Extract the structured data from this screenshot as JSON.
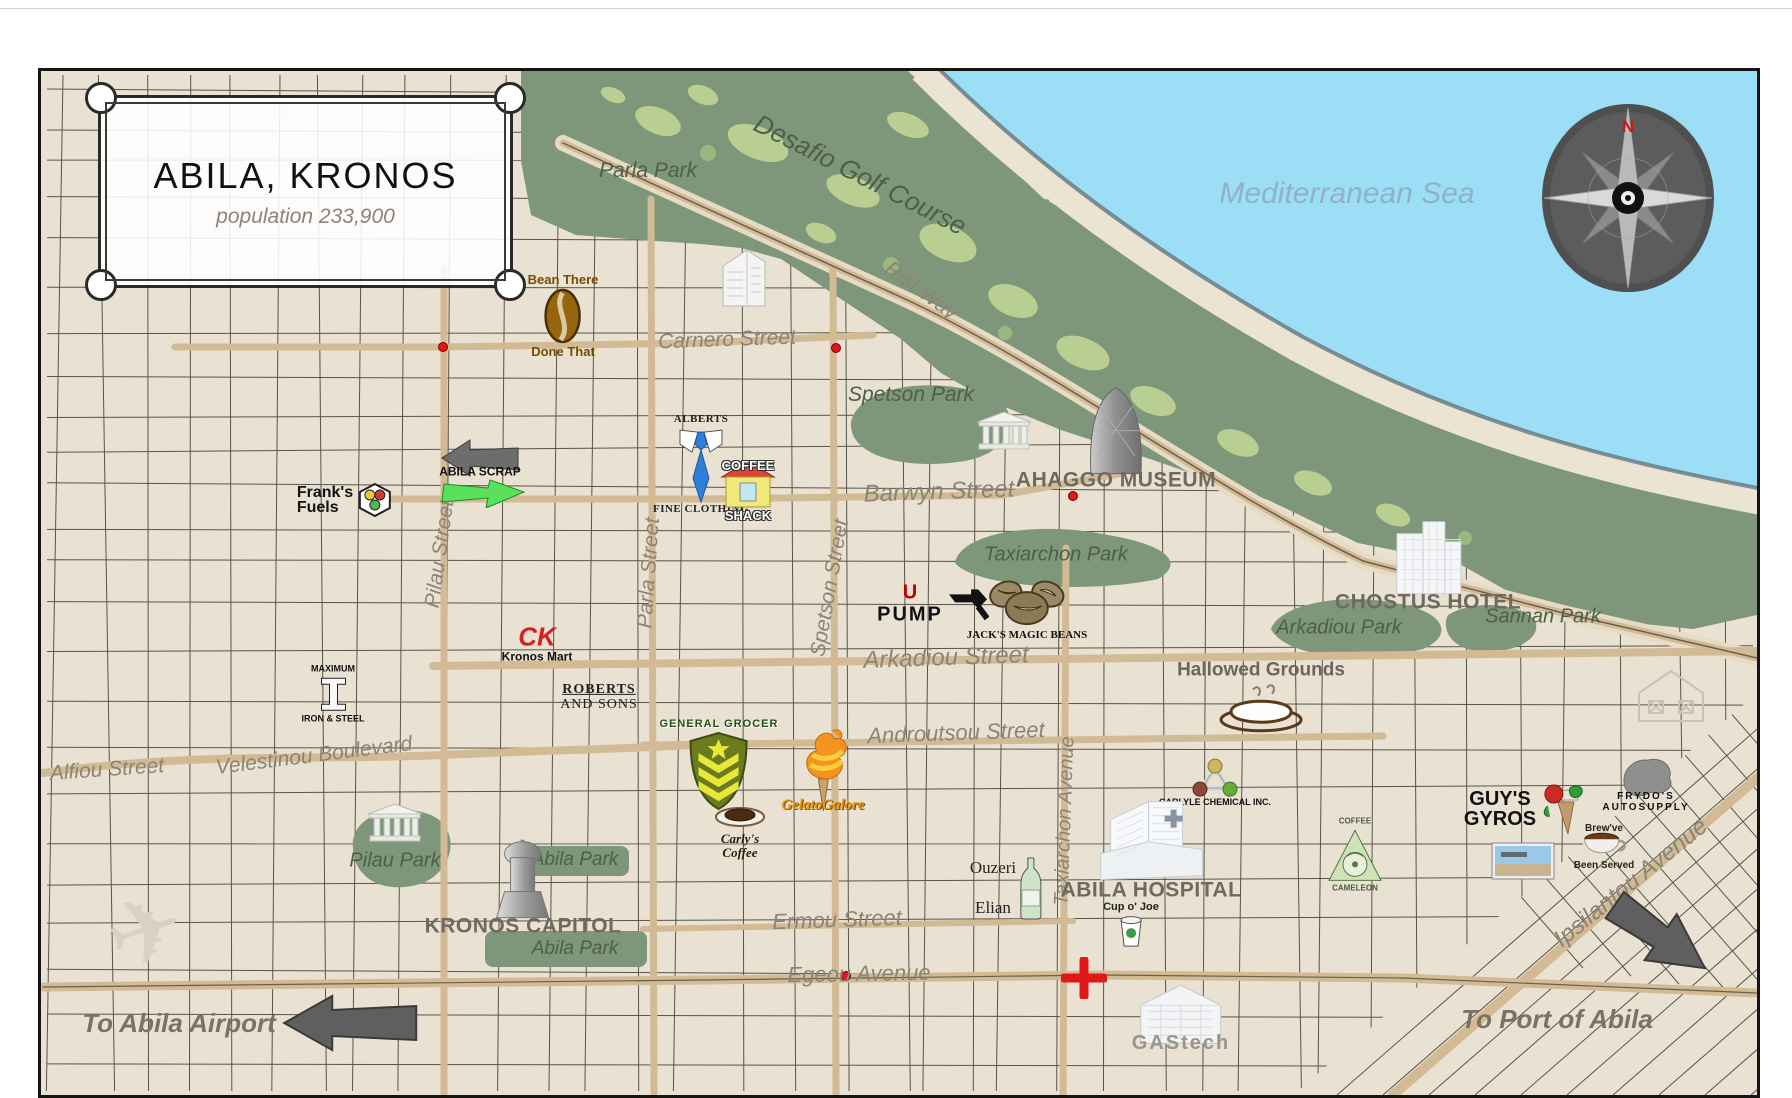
{
  "map": {
    "frame": {
      "title": "ABILA, KRONOS",
      "subtitle": "population 233,900"
    },
    "compass": {
      "north": "N"
    },
    "labels": [
      {
        "t": "Mediterranean Sea",
        "x": 1344,
        "y": 191,
        "r": 0,
        "s": 30,
        "k": "sea"
      },
      {
        "t": "Desafio Golf Course",
        "x": 857,
        "y": 172,
        "r": 27,
        "s": 26,
        "k": "park"
      },
      {
        "t": "Rist Way",
        "x": 918,
        "y": 288,
        "r": 36,
        "s": 21,
        "k": "street"
      },
      {
        "t": "Parla Park",
        "x": 645,
        "y": 168,
        "r": 0,
        "s": 21,
        "k": "park"
      },
      {
        "t": "Spetson Park",
        "x": 908,
        "y": 392,
        "r": 0,
        "s": 21,
        "k": "park"
      },
      {
        "t": "Taxiarchon Park",
        "x": 1053,
        "y": 552,
        "r": 0,
        "s": 20,
        "k": "park"
      },
      {
        "t": "Arkadiou Park",
        "x": 1336,
        "y": 625,
        "r": 0,
        "s": 20,
        "k": "park"
      },
      {
        "t": "Sannan Park",
        "x": 1540,
        "y": 614,
        "r": 0,
        "s": 20,
        "k": "park"
      },
      {
        "t": "Pilau Park",
        "x": 392,
        "y": 858,
        "r": 0,
        "s": 20,
        "k": "park"
      },
      {
        "t": "Abila Park",
        "x": 572,
        "y": 857,
        "r": 0,
        "s": 19,
        "k": "park"
      },
      {
        "t": "Abila Park",
        "x": 572,
        "y": 946,
        "r": 0,
        "s": 19,
        "k": "park"
      },
      {
        "t": "Carnero Street",
        "x": 724,
        "y": 337,
        "r": -2,
        "s": 21,
        "k": "street"
      },
      {
        "t": "Barwyn Street",
        "x": 936,
        "y": 489,
        "r": -2,
        "s": 24,
        "k": "street"
      },
      {
        "t": "Arkadiou Street",
        "x": 943,
        "y": 655,
        "r": -2,
        "s": 24,
        "k": "street"
      },
      {
        "t": "Androutsou Street",
        "x": 953,
        "y": 730,
        "r": -2,
        "s": 22,
        "k": "street"
      },
      {
        "t": "Velestinou Boulevard",
        "x": 311,
        "y": 753,
        "r": -7,
        "s": 21,
        "k": "street"
      },
      {
        "t": "Alfiou Street",
        "x": 104,
        "y": 767,
        "r": -4,
        "s": 21,
        "k": "street"
      },
      {
        "t": "Ermou Street",
        "x": 834,
        "y": 917,
        "r": -2,
        "s": 22,
        "k": "street"
      },
      {
        "t": "Egeou Avenue",
        "x": 856,
        "y": 971,
        "r": -1,
        "s": 22,
        "k": "street"
      },
      {
        "t": "Pilau Street",
        "x": 437,
        "y": 551,
        "r": -82,
        "s": 21,
        "k": "street"
      },
      {
        "t": "Parla Street",
        "x": 646,
        "y": 570,
        "r": -86,
        "s": 21,
        "k": "street"
      },
      {
        "t": "Spetson Street",
        "x": 827,
        "y": 585,
        "r": -80,
        "s": 21,
        "k": "street"
      },
      {
        "t": "Taxiarchon Avenue",
        "x": 1062,
        "y": 818,
        "r": -88,
        "s": 20,
        "k": "street"
      },
      {
        "t": "Ipsilantou Avenue",
        "x": 1628,
        "y": 880,
        "r": -39,
        "s": 24,
        "k": "street"
      }
    ],
    "landmarks": [
      {
        "name": "bean-there-done-that",
        "x": 560,
        "y": 313,
        "icon": "bean",
        "above": [
          "Bean There"
        ],
        "below": [
          "Done That"
        ],
        "cls": "c-brown"
      },
      {
        "name": "franks-fuels",
        "x": 342,
        "y": 497,
        "icon": "hexdots",
        "lines": [
          "Frank's",
          "Fuels"
        ],
        "cls": "c-franks",
        "layout": "row"
      },
      {
        "name": "abila-scrap",
        "x": 477,
        "y": 469,
        "icon": "scrap",
        "over": [
          "ABILA SCRAP"
        ],
        "cls": ""
      },
      {
        "name": "alberts-fine-clothing",
        "x": 698,
        "y": 462,
        "icon": "tie",
        "above": [
          "ALBERTS"
        ],
        "below": [
          "FINE CLOTHING"
        ],
        "cls": "c-alberts"
      },
      {
        "name": "coffee-shack",
        "x": 745,
        "y": 488,
        "icon": "shack",
        "above": [
          "COFFEE"
        ],
        "below": [
          "SHACK"
        ],
        "cls": "c-outline"
      },
      {
        "name": "ahaggo-museum",
        "x": 1113,
        "y": 436,
        "icon": "dome",
        "below": [
          "AHAGGO MUSEUM"
        ],
        "cls": "c-graycaps"
      },
      {
        "name": "museum-temple",
        "x": 1001,
        "y": 428,
        "icon": "temple",
        "cls": ""
      },
      {
        "name": "chostus-hotel",
        "x": 1425,
        "y": 562,
        "icon": "hotel",
        "below": [
          "CHOSTUS HOTEL"
        ],
        "cls": "c-graycaps"
      },
      {
        "name": "u-pump",
        "x": 930,
        "y": 601,
        "icon": "nozzle",
        "lines": [
          "U",
          "PUMP"
        ],
        "cls": "c-upump",
        "layout": "row"
      },
      {
        "name": "jacks-magic-beans",
        "x": 1024,
        "y": 605,
        "icon": "beans3",
        "below": [
          "JACK'S MAGIC BEANS"
        ],
        "cls": "c-scbk"
      },
      {
        "name": "kronos-mart",
        "x": 534,
        "y": 640,
        "above": [
          "CK"
        ],
        "below": [
          "Kronos Mart"
        ],
        "cls": "c-kmart"
      },
      {
        "name": "roberts-and-sons",
        "x": 596,
        "y": 694,
        "lines": [
          "ROBERTS",
          "AND SONS"
        ],
        "cls": "c-roberts"
      },
      {
        "name": "maximum-iron-steel",
        "x": 330,
        "y": 691,
        "icon": "ibeam",
        "above": [
          "MAXIMUM"
        ],
        "below": [
          "IRON & STEEL"
        ],
        "cls": "c-tinybk"
      },
      {
        "name": "hallowed-grounds",
        "x": 1258,
        "y": 694,
        "icon": "cupbig",
        "above": [
          "Hallowed Grounds"
        ],
        "cls": "c-hallowed"
      },
      {
        "name": "general-grocer",
        "x": 716,
        "y": 762,
        "icon": "shield",
        "above": [
          "GENERAL GROCER"
        ],
        "cls": "c-grocer"
      },
      {
        "name": "gelatogalore",
        "x": 820,
        "y": 766,
        "icon": "gelato",
        "below": [
          "GelatoGalore"
        ],
        "cls": "c-gelato"
      },
      {
        "name": "carlys-coffee",
        "x": 737,
        "y": 828,
        "icon": "cupsmall",
        "below": [
          "Carly's",
          "Coffee"
        ],
        "cls": "c-carlys"
      },
      {
        "name": "carlyle-chemical",
        "x": 1212,
        "y": 780,
        "icon": "molecule",
        "below": [
          "CARLYLE CHEMICAL INC."
        ],
        "cls": "c-tinybk"
      },
      {
        "name": "coffee-cameleon",
        "x": 1352,
        "y": 852,
        "icon": "camtriangle",
        "above": [
          "COFFEE"
        ],
        "below": [
          "CAMELEON"
        ],
        "cls": "c-tinygray"
      },
      {
        "name": "ouzeri-elian",
        "x": 1003,
        "y": 885,
        "icon": "bottle",
        "lines": [
          "Ouzeri",
          "Elian"
        ],
        "cls": "c-ouzeri",
        "layout": "row"
      },
      {
        "name": "abila-hospital",
        "x": 1148,
        "y": 840,
        "icon": "hospital",
        "below": [
          "ABILA HOSPITAL"
        ],
        "cls": "c-graycaps"
      },
      {
        "name": "cup-o-joe",
        "x": 1128,
        "y": 922,
        "icon": "cupjoe",
        "above": [
          "Cup o' Joe"
        ],
        "cls": "c-joes"
      },
      {
        "name": "guys-gyros",
        "x": 1523,
        "y": 806,
        "icon": "gyros",
        "lines": [
          "GUY'S",
          "GYROS"
        ],
        "cls": "c-guys",
        "layout": "row"
      },
      {
        "name": "storefront-photo",
        "x": 1520,
        "y": 858,
        "icon": "photo",
        "cls": ""
      },
      {
        "name": "frydos-autosupply",
        "x": 1643,
        "y": 780,
        "icon": "frydo",
        "below": [
          "FRYDO'S",
          "AUTOSUPPLY"
        ],
        "cls": "c-frydos"
      },
      {
        "name": "brewve-been-served",
        "x": 1601,
        "y": 845,
        "icon": "brewcup",
        "above": [
          "Brew've"
        ],
        "below": [
          "Been Served"
        ],
        "cls": "c-brew"
      },
      {
        "name": "sketched-house",
        "x": 1668,
        "y": 692,
        "icon": "housesketch",
        "cls": ""
      },
      {
        "name": "kronos-capitol",
        "x": 520,
        "y": 885,
        "icon": "capitol",
        "below": [
          "KRONOS CAPITOL"
        ],
        "cls": "c-graycaps"
      },
      {
        "name": "pilau-park-temple",
        "x": 392,
        "y": 820,
        "icon": "temple",
        "cls": ""
      },
      {
        "name": "airplane-sketch",
        "x": 143,
        "y": 929,
        "icon": "plane",
        "cls": ""
      },
      {
        "name": "gastech",
        "x": 1178,
        "y": 1014,
        "icon": "gastechb",
        "below": [
          "GAStech"
        ],
        "cls": "c-gascaps"
      },
      {
        "name": "apartment-building",
        "x": 741,
        "y": 273,
        "icon": "apt",
        "cls": ""
      },
      {
        "name": "to-abila-airport",
        "x": 248,
        "y": 1020,
        "icon": "arrowL",
        "lines": [
          "To Abila Airport"
        ],
        "cls": "c-toarrow",
        "layout": "row"
      },
      {
        "name": "to-port-of-abila",
        "x": 1554,
        "y": 1016,
        "lines": [
          "To Port of Abila"
        ],
        "cls": "c-toarrow"
      },
      {
        "name": "port-arrow",
        "x": 1656,
        "y": 933,
        "icon": "arrowSE",
        "cls": ""
      },
      {
        "name": "emergency-cross",
        "x": 1081,
        "y": 975,
        "icon": "redcross",
        "cls": ""
      }
    ],
    "markers": {
      "dots": [
        [
          440,
          344
        ],
        [
          833,
          345
        ],
        [
          1070,
          493
        ],
        [
          843,
          973
        ]
      ]
    }
  }
}
